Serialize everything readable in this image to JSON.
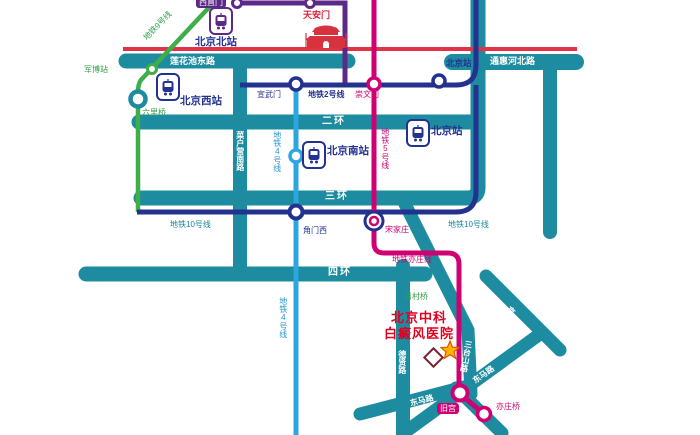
{
  "stations": {
    "xizhimen": "西直门",
    "beijing_north": "北京北站",
    "junbo": "军博站",
    "beijing_west": "北京西站",
    "liuliqiao": "六里桥",
    "xuanwumen": "宣武门",
    "chongwenmen": "崇文门",
    "beijing_station": "北京站",
    "tiananmen": "天安门",
    "beijing_south": "北京南站",
    "jiaomenxi": "角门西",
    "songjiazhuang": "宋家庄",
    "jiugong": "旧宫",
    "yizhuangqiao": "亦庄桥"
  },
  "lines": {
    "line9": "地铁9号线",
    "line2": "地铁2号线",
    "line4": "地铁4号线",
    "line5": "地铁5号线",
    "line10": "地铁10号线",
    "yizhuang": "地铁亦庄线"
  },
  "roads": {
    "lianhuachi": "莲花池东路",
    "tonghui": "通惠河北路",
    "ring2": "二环",
    "ring3": "三环",
    "ring4": "四环",
    "caihuying": "菜户营南路",
    "xiaocunqiao": "肖村桥",
    "dexian": "德贤路",
    "santaishan": "三台山路",
    "jinghu": "京沪高速",
    "dongma": "东马路"
  },
  "hospital": {
    "name_line1": "北京中科",
    "name_line2": "白癜风医院"
  },
  "colors": {
    "road_teal": "#1e8ca0",
    "line1_red": "#e03347",
    "line2_navy": "#23318f",
    "line4_blue": "#2ba6e0",
    "line5_magenta": "#cf0072",
    "line9_green": "#3fae49",
    "purple": "#5c2a86",
    "hospital_red": "#e00020",
    "star_gold": "#ffb400"
  }
}
